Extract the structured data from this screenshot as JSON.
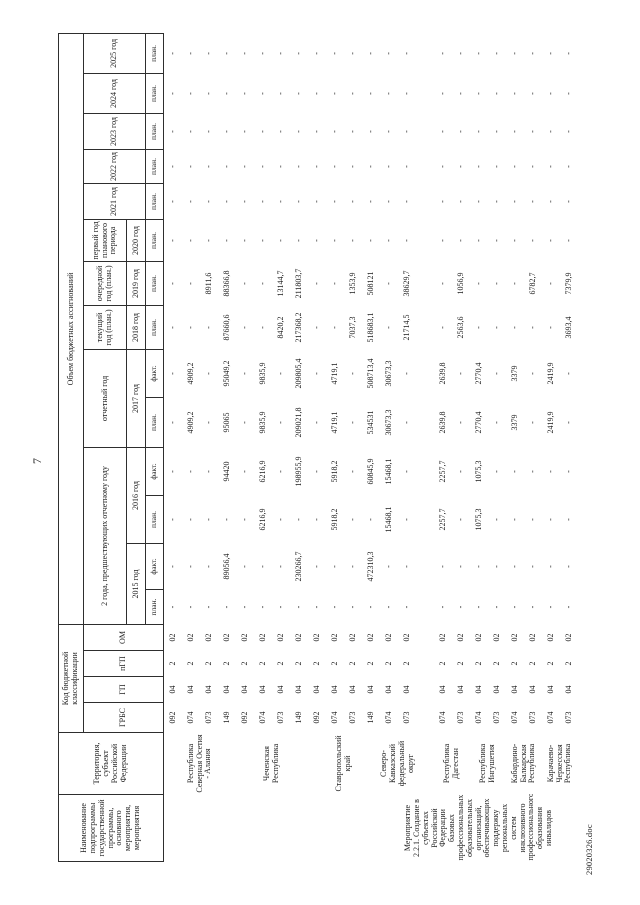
{
  "page": {
    "number": "7",
    "footer": "29020326.doc"
  },
  "table": {
    "headers": {
      "name": "Наименование подпрограммы государственной программы, основного мероприятия, мероприятия",
      "territory": "Территория, субъект Российской Федерации",
      "budget_code": "Код бюджетной классификации",
      "code_cols": [
        "ГРБС",
        "ГП",
        "пГП",
        "ОМ"
      ],
      "volume": "Объем бюджетных ассигнований",
      "groups": {
        "prev2": "2 года, предшествующих отчетному году",
        "report": "отчетный год",
        "current": "текущий год (план.)",
        "next": "очередной год (план.)",
        "first_plan": "первый год планового периода"
      },
      "years": [
        "2015 год",
        "2016 год",
        "2017 год",
        "2018 год",
        "2019 год",
        "2020 год",
        "2021 год",
        "2022 год",
        "2023 год",
        "2024 год",
        "2025 год"
      ],
      "plan": "план.",
      "fact": "факт."
    },
    "value_columns": [
      "2015 план",
      "2015 факт",
      "2016 план",
      "2016 факт",
      "2017 план",
      "2017 факт",
      "2018 план",
      "2019 план",
      "2020 план",
      "2021 план",
      "2022 план",
      "2023 план",
      "2024 план",
      "2025 план"
    ],
    "rows": [
      {
        "name": "",
        "name_rowspan": 12,
        "territory": "Республика Северная Осетия - Алания",
        "territory_rowspan": 4,
        "grbs": "092",
        "gp": "04",
        "pgp": "2",
        "om": "02",
        "values": [
          "-",
          "-",
          "-",
          "-",
          "-",
          "-",
          "-",
          "-",
          "-",
          "-",
          "-",
          "-",
          "-",
          "-"
        ]
      },
      {
        "grbs": "074",
        "gp": "04",
        "pgp": "2",
        "om": "02",
        "values": [
          "-",
          "-",
          "-",
          "-",
          "4909,2",
          "4909,2",
          "-",
          "-",
          "-",
          "-",
          "-",
          "-",
          "-",
          "-"
        ]
      },
      {
        "grbs": "073",
        "gp": "04",
        "pgp": "2",
        "om": "02",
        "values": [
          "-",
          "-",
          "-",
          "-",
          "-",
          "-",
          "-",
          "8911,6",
          "-",
          "-",
          "-",
          "-",
          "-",
          "-"
        ]
      },
      {
        "grbs": "149",
        "gp": "04",
        "pgp": "2",
        "om": "02",
        "values": [
          "-",
          "89056,4",
          "-",
          "94420",
          "95065",
          "95049,2",
          "87660,6",
          "88366,8",
          "-",
          "-",
          "-",
          "-",
          "-",
          "-"
        ]
      },
      {
        "territory": "Чеченская Республика",
        "territory_rowspan": 4,
        "grbs": "092",
        "gp": "04",
        "pgp": "2",
        "om": "02",
        "values": [
          "-",
          "-",
          "-",
          "-",
          "-",
          "-",
          "-",
          "-",
          "-",
          "-",
          "-",
          "-",
          "-",
          "-"
        ]
      },
      {
        "grbs": "074",
        "gp": "04",
        "pgp": "2",
        "om": "02",
        "values": [
          "-",
          "-",
          "6216,9",
          "6216,9",
          "9835,9",
          "9835,9",
          "-",
          "-",
          "-",
          "-",
          "-",
          "-",
          "-",
          "-"
        ]
      },
      {
        "grbs": "073",
        "gp": "04",
        "pgp": "2",
        "om": "02",
        "values": [
          "-",
          "-",
          "-",
          "-",
          "-",
          "-",
          "8420,2",
          "13144,7",
          "-",
          "-",
          "-",
          "-",
          "-",
          "-"
        ]
      },
      {
        "grbs": "149",
        "gp": "04",
        "pgp": "2",
        "om": "02",
        "values": [
          "-",
          "230266,7",
          "-",
          "198955,9",
          "209021,8",
          "209805,4",
          "217368,2",
          "211803,7",
          "-",
          "-",
          "-",
          "-",
          "-",
          "-"
        ]
      },
      {
        "territory": "Ставропольский край",
        "territory_rowspan": 4,
        "grbs": "092",
        "gp": "04",
        "pgp": "2",
        "om": "02",
        "values": [
          "-",
          "-",
          "-",
          "-",
          "-",
          "-",
          "-",
          "-",
          "-",
          "-",
          "-",
          "-",
          "-",
          "-"
        ]
      },
      {
        "grbs": "074",
        "gp": "04",
        "pgp": "2",
        "om": "02",
        "values": [
          "-",
          "-",
          "5918,2",
          "5918,2",
          "4719,1",
          "4719,1",
          "-",
          "-",
          "-",
          "-",
          "-",
          "-",
          "-",
          "-"
        ]
      },
      {
        "grbs": "073",
        "gp": "04",
        "pgp": "2",
        "om": "02",
        "values": [
          "-",
          "-",
          "-",
          "-",
          "-",
          "-",
          "7037,3",
          "1353,9",
          "-",
          "-",
          "-",
          "-",
          "-",
          "-"
        ]
      },
      {
        "grbs": "149",
        "gp": "04",
        "pgp": "2",
        "om": "02",
        "values": [
          "-",
          "472310,3",
          "-",
          "60845,9",
          "534531",
          "508713,4",
          "518683,1",
          "508121",
          "-",
          "-",
          "-",
          "-",
          "-",
          "-"
        ]
      },
      {
        "name": "Мероприятие 2.2.1. Создание в субъектах Российской Федерации базовых профессиональных образовательных организаций, обеспечивающих поддержку региональных систем инклюзивного профессионального образования инвалидов",
        "name_rowspan": 11,
        "territory": "Северо-Кавказский федеральный округ",
        "territory_rowspan": 2,
        "grbs": "074",
        "gp": "04",
        "pgp": "2",
        "om": "02",
        "values": [
          "-",
          "-",
          "15468,1",
          "15468,1",
          "30673,3",
          "30673,3",
          "-",
          "-",
          "-",
          "-",
          "-",
          "-",
          "-",
          "-"
        ]
      },
      {
        "grbs": "073",
        "gp": "04",
        "pgp": "2",
        "om": "02",
        "values": [
          "-",
          "-",
          "-",
          "-",
          "-",
          "-",
          "21714,5",
          "38629,7",
          "-",
          "-",
          "-",
          "-",
          "-",
          "-"
        ]
      },
      {
        "spacer": true
      },
      {
        "territory": "Республика Дагестан",
        "territory_rowspan": 2,
        "grbs": "074",
        "gp": "04",
        "pgp": "2",
        "om": "02",
        "values": [
          "-",
          "-",
          "2257,7",
          "2257,7",
          "2639,8",
          "2639,8",
          "-",
          "-",
          "-",
          "-",
          "-",
          "-",
          "-",
          "-"
        ]
      },
      {
        "grbs": "073",
        "gp": "04",
        "pgp": "2",
        "om": "02",
        "values": [
          "-",
          "-",
          "-",
          "-",
          "-",
          "-",
          "2563,6",
          "1056,9",
          "-",
          "-",
          "-",
          "-",
          "-",
          "-"
        ]
      },
      {
        "territory": "Республика Ингушетия",
        "territory_rowspan": 2,
        "grbs": "074",
        "gp": "04",
        "pgp": "2",
        "om": "02",
        "values": [
          "-",
          "-",
          "1075,3",
          "1075,3",
          "2770,4",
          "2770,4",
          "-",
          "-",
          "-",
          "-",
          "-",
          "-",
          "-",
          "-"
        ]
      },
      {
        "grbs": "073",
        "gp": "04",
        "pgp": "2",
        "om": "02",
        "values": [
          "-",
          "-",
          "-",
          "-",
          "-",
          "-",
          "-",
          "-",
          "-",
          "-",
          "-",
          "-",
          "-",
          "-"
        ]
      },
      {
        "territory": "Кабардино-Балкарская Республика",
        "territory_rowspan": 2,
        "grbs": "074",
        "gp": "04",
        "pgp": "2",
        "om": "02",
        "values": [
          "-",
          "-",
          "-",
          "-",
          "3379",
          "3379",
          "-",
          "-",
          "-",
          "-",
          "-",
          "-",
          "-",
          "-"
        ]
      },
      {
        "grbs": "073",
        "gp": "04",
        "pgp": "2",
        "om": "02",
        "values": [
          "-",
          "-",
          "-",
          "-",
          "-",
          "-",
          "-",
          "6782,7",
          "-",
          "-",
          "-",
          "-",
          "-",
          "-"
        ]
      },
      {
        "territory": "Карачаево-Черкесская Республика",
        "territory_rowspan": 2,
        "grbs": "074",
        "gp": "04",
        "pgp": "2",
        "om": "02",
        "values": [
          "-",
          "-",
          "-",
          "-",
          "2419,9",
          "2419,9",
          "-",
          "-",
          "-",
          "-",
          "-",
          "-",
          "-",
          "-"
        ]
      },
      {
        "grbs": "073",
        "gp": "04",
        "pgp": "2",
        "om": "02",
        "values": [
          "-",
          "-",
          "-",
          "-",
          "-",
          "-",
          "3693,4",
          "7379,9",
          "-",
          "-",
          "-",
          "-",
          "-",
          "-"
        ]
      }
    ]
  }
}
